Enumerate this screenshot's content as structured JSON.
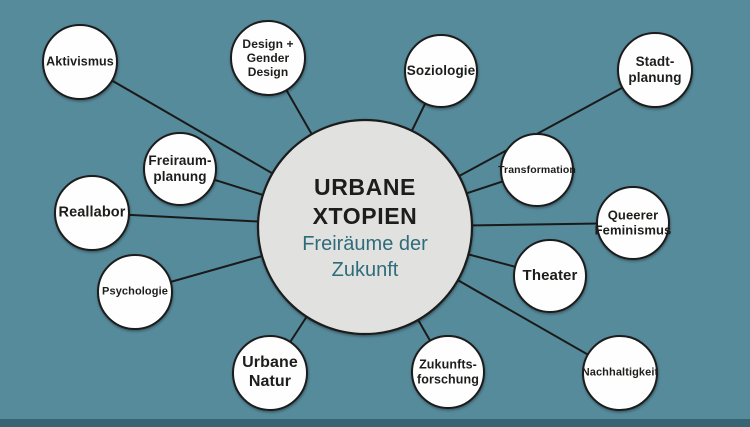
{
  "colors": {
    "background": "#568b9b",
    "bottom_bar": "#376473",
    "connector": "#1a1a1a",
    "node_fill": "#fefefe",
    "node_stroke": "#1a1a1a",
    "center_fill": "#e1e1e0",
    "center_stroke": "#1a1a1a",
    "label_color": "#1d1d1b",
    "center_title_color": "#1d1d1b",
    "center_subtitle_color": "#2f6c7b"
  },
  "canvas": {
    "width": 750,
    "height": 427,
    "bottom_bar_height": 8
  },
  "center": {
    "x": 365,
    "y": 227,
    "r": 107,
    "title_lines": [
      "URBANE",
      "XTOPIEN"
    ],
    "subtitle_lines": [
      "Freiräume der",
      "Zukunft"
    ],
    "title_text": "URBANE XTOPIEN",
    "subtitle_text": "Freiräume der Zukunft"
  },
  "nodes": [
    {
      "id": "aktivismus",
      "lines": [
        "Aktivismus"
      ],
      "x": 80,
      "y": 62,
      "r": 37,
      "font_size": 12.5
    },
    {
      "id": "design-gender-design",
      "lines": [
        "Design +",
        "Gender",
        "Design"
      ],
      "x": 268,
      "y": 58,
      "r": 37,
      "font_size": 12
    },
    {
      "id": "soziologie",
      "lines": [
        "Soziologie"
      ],
      "x": 441,
      "y": 71,
      "r": 36,
      "font_size": 13.5
    },
    {
      "id": "stadtplanung",
      "lines": [
        "Stadt-",
        "planung"
      ],
      "x": 655,
      "y": 70,
      "r": 37,
      "font_size": 13.5
    },
    {
      "id": "freiraumplanung",
      "lines": [
        "Freiraum-",
        "planung"
      ],
      "x": 180,
      "y": 169,
      "r": 36,
      "font_size": 13.5
    },
    {
      "id": "reallabor",
      "lines": [
        "Reallabor"
      ],
      "x": 92,
      "y": 213,
      "r": 37,
      "font_size": 14.5
    },
    {
      "id": "psychologie",
      "lines": [
        "Psychologie"
      ],
      "x": 135,
      "y": 292,
      "r": 37,
      "font_size": 11
    },
    {
      "id": "transformation",
      "lines": [
        "Transformation"
      ],
      "x": 537,
      "y": 170,
      "r": 36,
      "font_size": 10.5
    },
    {
      "id": "queerer-feminismus",
      "lines": [
        "Queerer",
        "Feminismus"
      ],
      "x": 633,
      "y": 223,
      "r": 36,
      "font_size": 13
    },
    {
      "id": "theater",
      "lines": [
        "Theater"
      ],
      "x": 550,
      "y": 276,
      "r": 36,
      "font_size": 15
    },
    {
      "id": "urbane-natur",
      "lines": [
        "Urbane",
        "Natur"
      ],
      "x": 270,
      "y": 373,
      "r": 37,
      "font_size": 16
    },
    {
      "id": "zukunftsforschung",
      "lines": [
        "Zukunfts-",
        "forschung"
      ],
      "x": 448,
      "y": 372,
      "r": 36,
      "font_size": 12.5
    },
    {
      "id": "nachhaltigkeit",
      "lines": [
        "Nachhaltigkeit"
      ],
      "x": 620,
      "y": 373,
      "r": 37,
      "font_size": 11
    }
  ]
}
